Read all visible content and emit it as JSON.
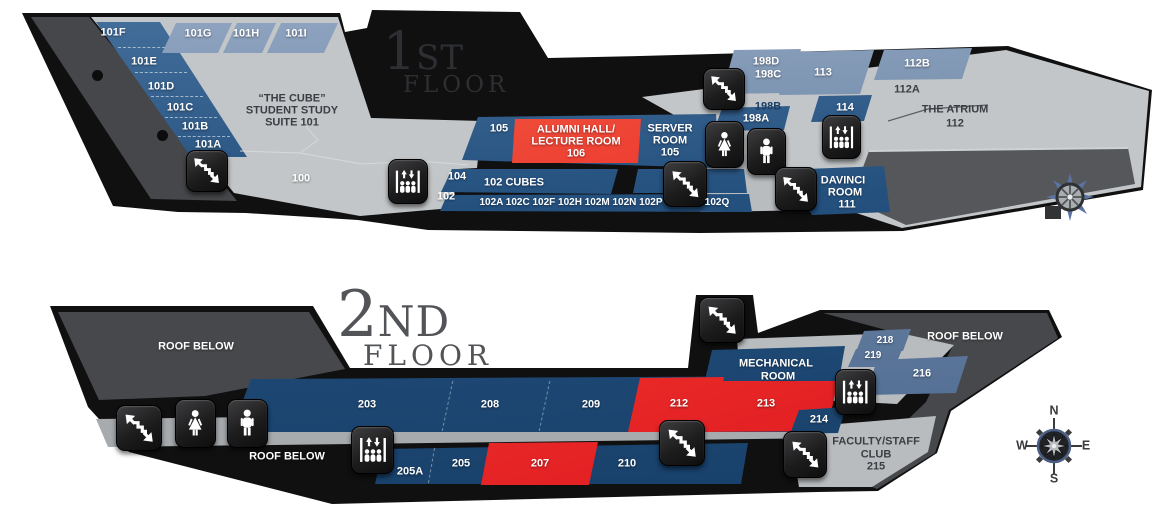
{
  "floor1": {
    "title": {
      "digit": "1",
      "suffix": "ST",
      "word": "FLOOR"
    },
    "rooms": {
      "f101f": "101F",
      "f101e": "101E",
      "f101d": "101D",
      "f101c": "101C",
      "f101b": "101B",
      "f101a": "101A",
      "f101g": "101G",
      "f101h": "101H",
      "f101i": "101I",
      "cube1": "“THE CUBE”",
      "cube2": "STUDENT STUDY",
      "cube3": "SUITE 101",
      "f100": "100",
      "f105s": "105",
      "alumni1": "ALUMNI HALL/",
      "alumni2": "LECTURE ROOM",
      "alumni3": "106",
      "server1": "SERVER",
      "server2": "ROOM",
      "server3": "105",
      "f104": "104",
      "f102": "102",
      "f102cubes": "102 CUBES",
      "row102": "102A 102C 102F 102H 102M 102N 102P",
      "f102q": "102Q",
      "f198d": "198D",
      "f198c": "198C",
      "f198b": "198B",
      "f198a": "198A",
      "f113": "113",
      "f112b": "112B",
      "f112a": "112A",
      "atrium1": "THE ATRIUM",
      "atrium2": "112",
      "f114": "114",
      "davinci1": "DAVINCI",
      "davinci2": "ROOM",
      "davinci3": "111"
    }
  },
  "floor2": {
    "title": {
      "digit": "2",
      "suffix": "ND",
      "word": "FLOOR"
    },
    "roof_left": "ROOF BELOW",
    "roof_bottom": "ROOF BELOW",
    "roof_right": "ROOF BELOW",
    "rooms": {
      "f203": "203",
      "f208": "208",
      "f209": "209",
      "f212": "212",
      "f213": "213",
      "f205a": "205A",
      "f205": "205",
      "f207": "207",
      "f210": "210",
      "f214": "214",
      "mech1": "MECHANICAL",
      "mech2": "ROOM",
      "f218": "218",
      "f219": "219",
      "f216": "216",
      "fac1": "FACULTY/STAFF",
      "fac2": "CLUB",
      "fac3": "215"
    },
    "compass": {
      "n": "N",
      "e": "E",
      "s": "S",
      "w": "W"
    }
  },
  "legend_icons": {
    "stairs": "stairs-icon",
    "elevator": "elevator-icon",
    "women_restroom": "restroom-women-icon",
    "men_restroom": "restroom-men-icon",
    "compass": "compass-rose-icon"
  },
  "colors": {
    "room_navy": "#24507e",
    "room_steel": "#64809f",
    "room_red": "#ec2d28",
    "floor_gray": "#c3c6c8",
    "roof_dark_gray": "#47484b",
    "outline_black": "#101011",
    "label_white": "#ffffff"
  }
}
